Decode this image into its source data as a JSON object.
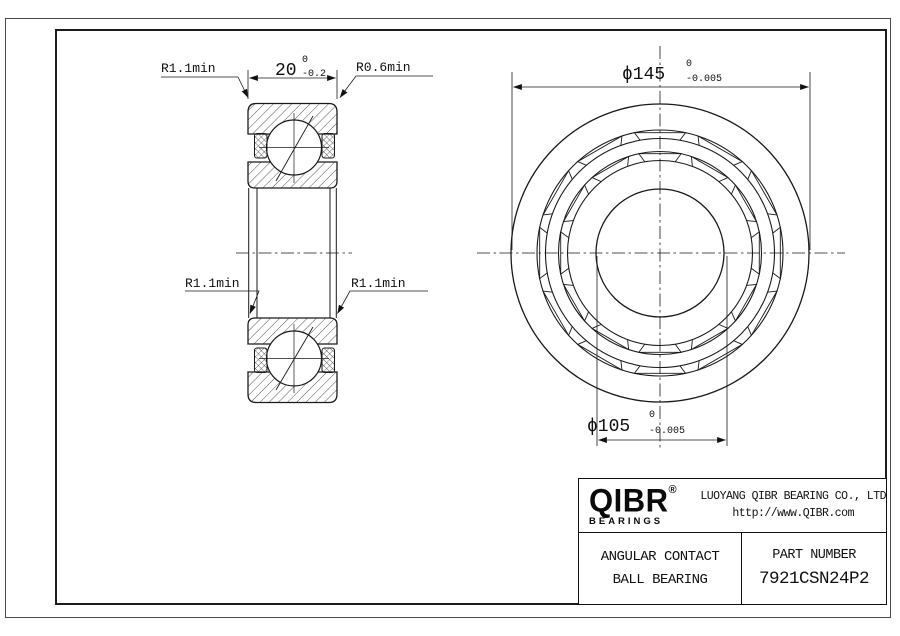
{
  "section_view": {
    "width_dim": {
      "value": "20",
      "tol_upper": "0",
      "tol_lower": "-0.2"
    },
    "radius_top_left": "R1.1min",
    "radius_top_right": "R0.6min",
    "radius_mid_left": "R1.1min",
    "radius_mid_right": "R1.1min"
  },
  "front_view": {
    "outer_dia": {
      "value": "ϕ145",
      "tol_upper": "0",
      "tol_lower": "-0.005"
    },
    "bore_dia": {
      "value": "ϕ105",
      "tol_upper": "0",
      "tol_lower": "-0.005"
    }
  },
  "title_block": {
    "logo": "QIBR",
    "registered": "®",
    "logo_sub": "BEARINGS",
    "company": "LUOYANG QIBR BEARING CO., LTD",
    "website": "http://www.QIBR.com",
    "product_line1": "ANGULAR CONTACT",
    "product_line2": "BALL BEARING",
    "part_label": "PART NUMBER",
    "part_number": "7921CSN24P2"
  }
}
